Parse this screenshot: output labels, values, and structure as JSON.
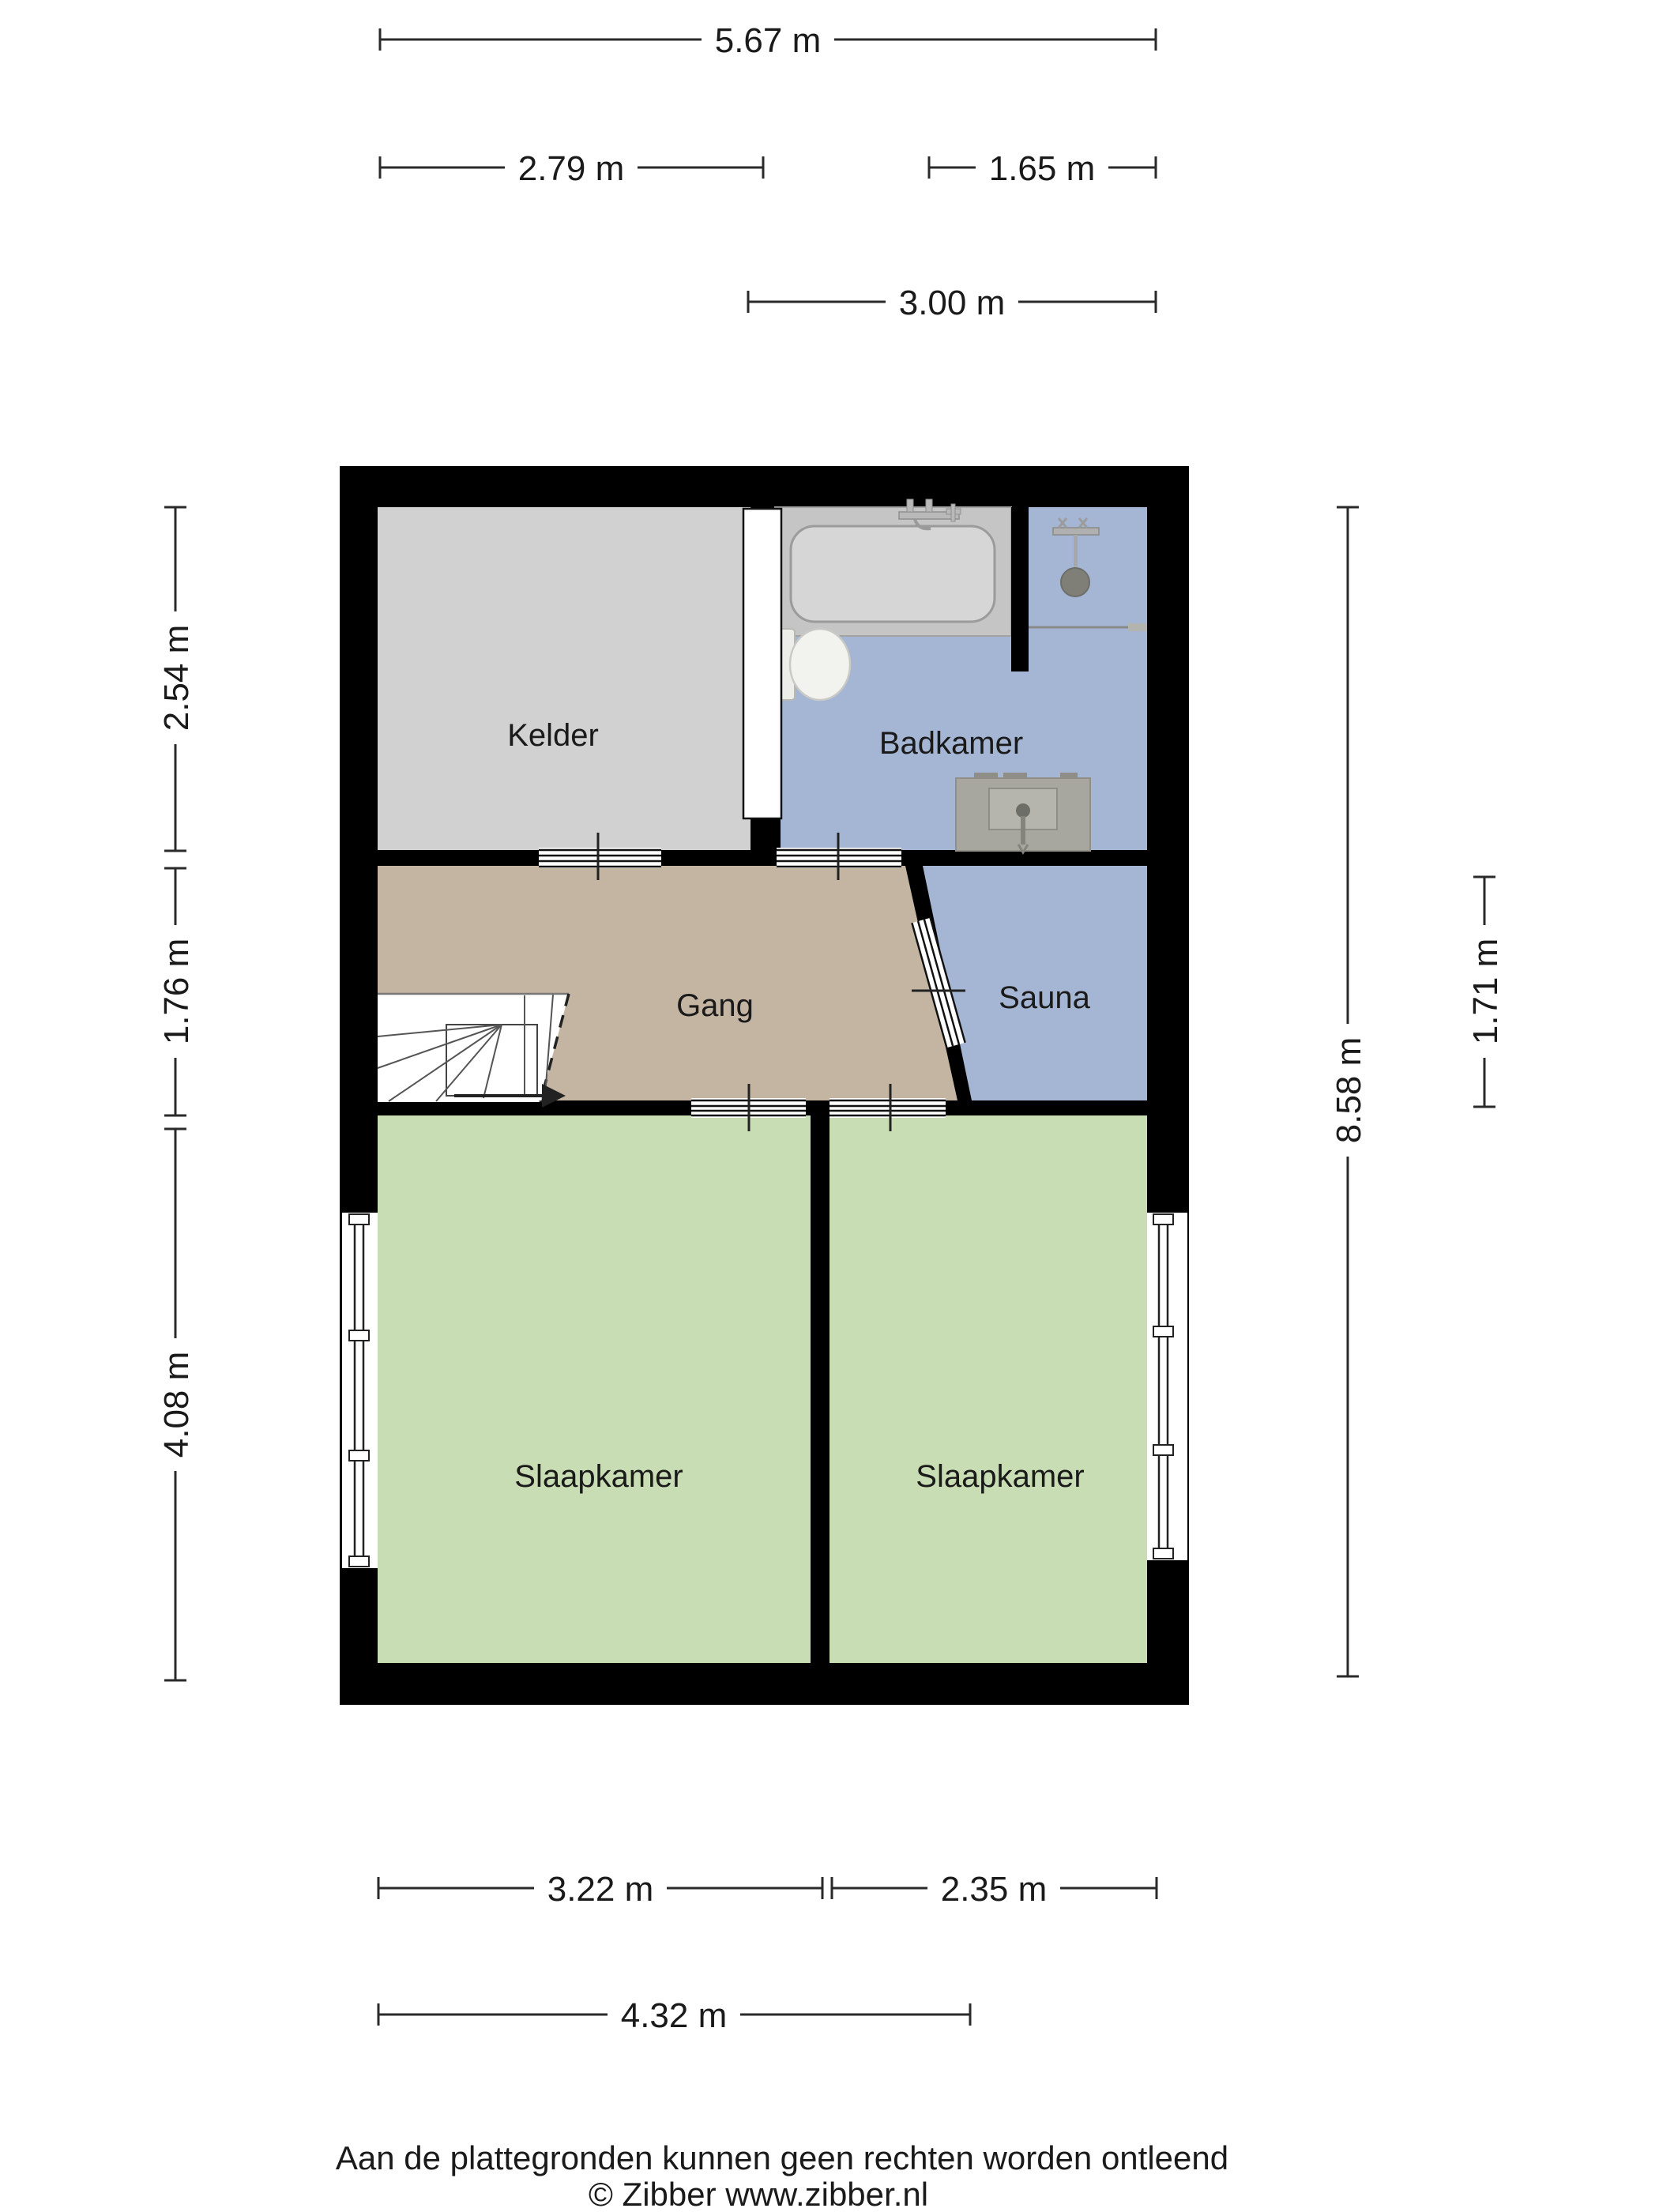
{
  "title": "Floor plan (plattegrond)",
  "colors": {
    "wall": "#000000",
    "background": "#ffffff",
    "dim_line": "#2a2a2a",
    "fixture_gray": "#c5c5c5",
    "sink_gray": "#a8a79f"
  },
  "rooms": {
    "kelder": {
      "label": "Kelder",
      "color": "#d1d1d1"
    },
    "badkamer": {
      "label": "Badkamer",
      "color": "#a5b6d4"
    },
    "gang": {
      "label": "Gang",
      "color": "#c4b5a3"
    },
    "sauna": {
      "label": "Sauna",
      "color": "#a5b6d4"
    },
    "slaapkamer_links": {
      "label": "Slaapkamer",
      "color": "#c9ddb4"
    },
    "slaapkamer_rechts": {
      "label": "Slaapkamer",
      "color": "#c9ddb4"
    }
  },
  "fixtures": [
    "bath",
    "bath-faucet",
    "shower",
    "shower-head",
    "glass-screen",
    "toilet",
    "sink",
    "stairs",
    "windows",
    "doors"
  ],
  "dimensions": {
    "top_total": "5.67 m",
    "top_left": "2.79 m",
    "top_right": "1.65 m",
    "top_badkamer": "3.00 m",
    "left_kelder": "2.54 m",
    "left_gang": "1.76 m",
    "left_slaapkamer": "4.08 m",
    "right_total": "8.58 m",
    "right_sauna": "1.71 m",
    "bottom_left": "3.22 m",
    "bottom_right": "2.35 m",
    "bottom_total": "4.32 m"
  },
  "footer": {
    "line1": "Aan de plattegronden kunnen geen rechten worden ontleend",
    "line2": "© Zibber www.zibber.nl"
  }
}
